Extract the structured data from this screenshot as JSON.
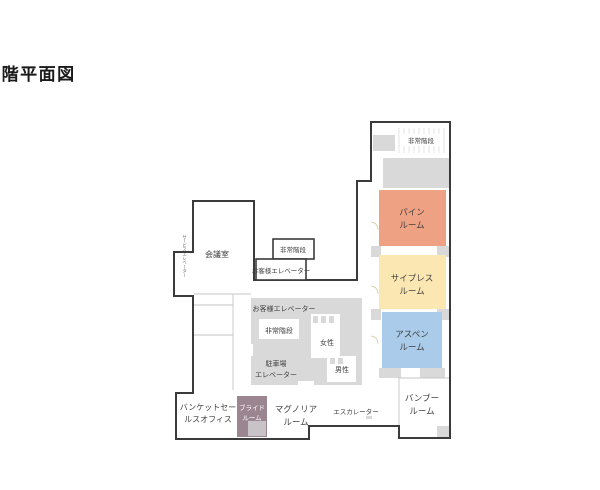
{
  "title": "5 階平面図",
  "colors": {
    "wall": "#3b3b3b",
    "block_gray": "#d9d9d9",
    "thin_line": "#c6c6c6",
    "pine": "#efa184",
    "cypress": "#fbe7b2",
    "aspen": "#aacbe9",
    "bride": "#9a8591",
    "bride_inner": "#c9c2c6",
    "label_text": "#3f3f3f"
  },
  "rooms": {
    "pine": {
      "line1": "パイン",
      "line2": "ルーム",
      "color": "#efa184"
    },
    "cypress": {
      "line1": "サイプレス",
      "line2": "ルーム",
      "color": "#fbe7b2"
    },
    "aspen": {
      "line1": "アスペン",
      "line2": "ルーム",
      "color": "#aacbe9"
    },
    "bamboo": {
      "line1": "バンブー",
      "line2": "ルーム"
    },
    "bride": {
      "line1": "ブライド",
      "line2": "ルーム",
      "color": "#9a8591"
    },
    "magnolia": {
      "line1": "マグノリア",
      "line2": "ルーム"
    },
    "banquet_office": {
      "line1": "バンケットセー",
      "line2": "ルスオフィス"
    },
    "meeting": {
      "label": "会議室"
    }
  },
  "facilities": {
    "emergency_stairs_top": "非常階段",
    "emergency_stairs_mid": "非常階段",
    "emergency_stairs_center": "非常階段",
    "guest_elevator_upper": "お客様エレベーター",
    "guest_elevator_lower": "お客様エレベーター",
    "parking_elevator_line1": "駐車場",
    "parking_elevator_line2": "エレベーター",
    "womens": "女性",
    "mens": "男性",
    "escalator": "エスカレーター",
    "service_elevator": "サービスエレベーター"
  }
}
